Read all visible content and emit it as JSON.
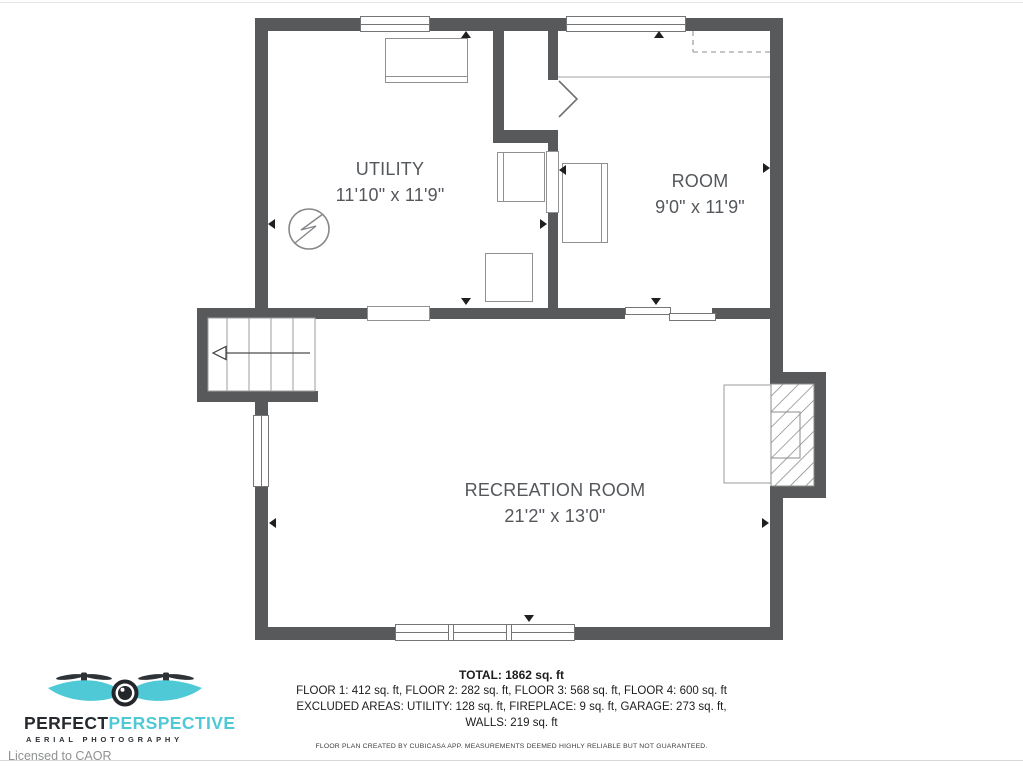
{
  "document": {
    "type": "floor-plan",
    "creator_note": "FLOOR PLAN CREATED BY CUBICASA APP. MEASUREMENTS DEEMED HIGHLY RELIABLE BUT NOT GUARANTEED."
  },
  "rooms": {
    "utility": {
      "name": "UTILITY",
      "dims": "11'10\" x 11'9\""
    },
    "room": {
      "name": "ROOM",
      "dims": "9'0\" x 11'9\""
    },
    "recreation": {
      "name": "RECREATION ROOM",
      "dims": "21'2\" x 13'0\""
    }
  },
  "summary": {
    "total": "TOTAL: 1862 sq. ft",
    "floors": "FLOOR 1: 412 sq. ft, FLOOR 2: 282 sq. ft, FLOOR 3: 568 sq. ft, FLOOR 4: 600 sq. ft",
    "excluded": "EXCLUDED AREAS: UTILITY: 128 sq. ft, FIREPLACE: 9 sq. ft, GARAGE: 273 sq. ft,",
    "walls": "WALLS: 219 sq. ft"
  },
  "branding": {
    "name_primary": "PERFECT",
    "name_secondary": "PERSPECTIVE",
    "tagline": "AERIAL PHOTOGRAPHY",
    "license": "Licensed to CAOR"
  },
  "icons": {
    "water_heater": "circle-with-lightning-bolt",
    "stairs": "treads-with-left-arrow",
    "fireplace": "hatched-box",
    "logo": "drone-with-camera"
  },
  "colors": {
    "wall": "#58595b",
    "label_text": "#54575c",
    "accent_teal": "#4fc9d6",
    "marker_black": "#1f1f1f"
  }
}
